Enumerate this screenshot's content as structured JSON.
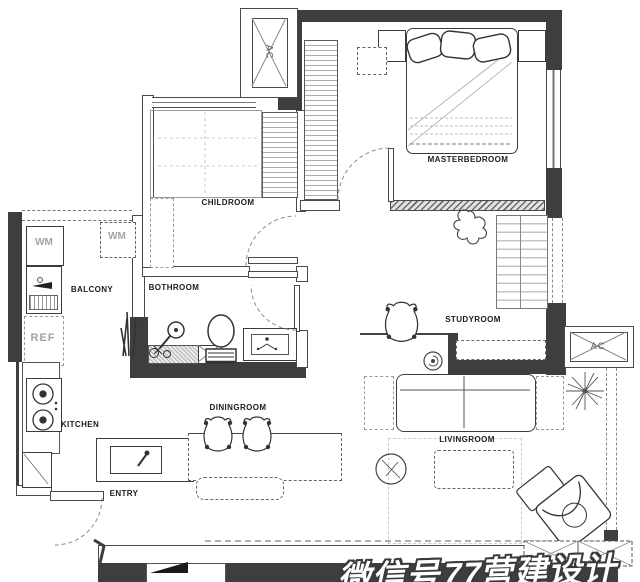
{
  "rooms": [
    {
      "id": "masterbedroom",
      "label": "MASTERBEDROOM"
    },
    {
      "id": "childroom",
      "label": "CHILDROOM"
    },
    {
      "id": "bothroom",
      "label": "BOTHROOM"
    },
    {
      "id": "balcony",
      "label": "BALCONY"
    },
    {
      "id": "kitchen",
      "label": "KITCHEN"
    },
    {
      "id": "diningroom",
      "label": "DININGROOM"
    },
    {
      "id": "entry",
      "label": "ENTRY"
    },
    {
      "id": "livingroom",
      "label": "LIVINGROOM"
    },
    {
      "id": "studyroom",
      "label": "STUDYROOM"
    }
  ],
  "fixtures": {
    "wm_left": "WM",
    "wm_right": "WM",
    "ref": "REF",
    "ac_top": "AC",
    "ac_right": "AC"
  },
  "watermark": {
    "text": "微信号77营建设计"
  },
  "colors": {
    "wall": "#3e3e3e",
    "line": "#555555",
    "label": "#1c1c1c",
    "muted": "#a3a3a3"
  }
}
